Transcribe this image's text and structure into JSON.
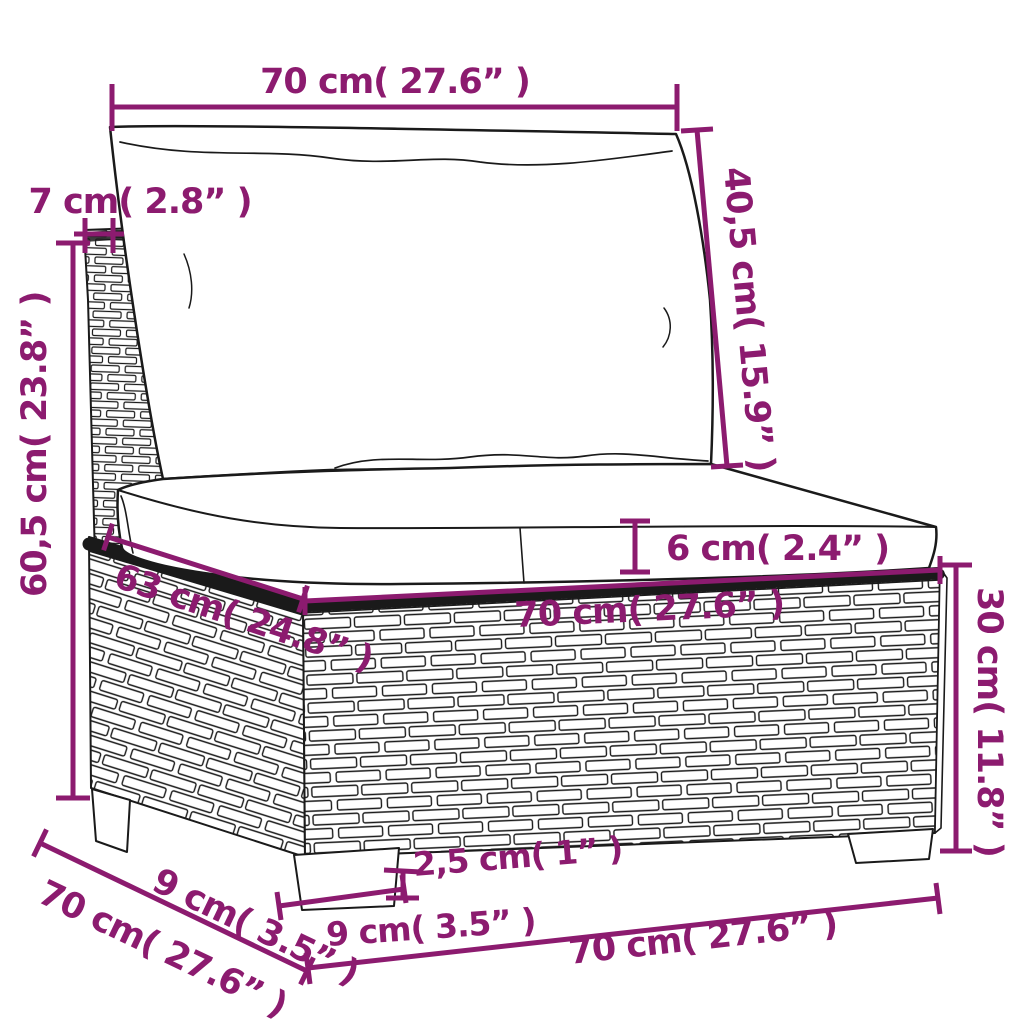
{
  "diagram": {
    "accent_color": "#8C1B6F",
    "outline_color": "#1a1a1a",
    "background_color": "#ffffff"
  },
  "dims": {
    "top_width": "70 cm( 27.6” )",
    "post_width": "7 cm( 2.8” )",
    "back_cushion_height": "40,5 cm( 15.9” )",
    "overall_height": "60,5 cm( 23.8” )",
    "cushion_thickness": "6 cm( 2.4” )",
    "seat_front_width": "70 cm( 27.6” )",
    "base_height": "30 cm( 11.8” )",
    "seat_depth": "63 cm( 24.8” )",
    "side_leg_depth": "9 cm( 3.5” )",
    "side_depth": "70 cm( 27.6” )",
    "leg_width": "9 cm( 3.5” )",
    "leg_height": "2,5 cm( 1” )",
    "bottom_width": "70 cm( 27.6” )"
  }
}
